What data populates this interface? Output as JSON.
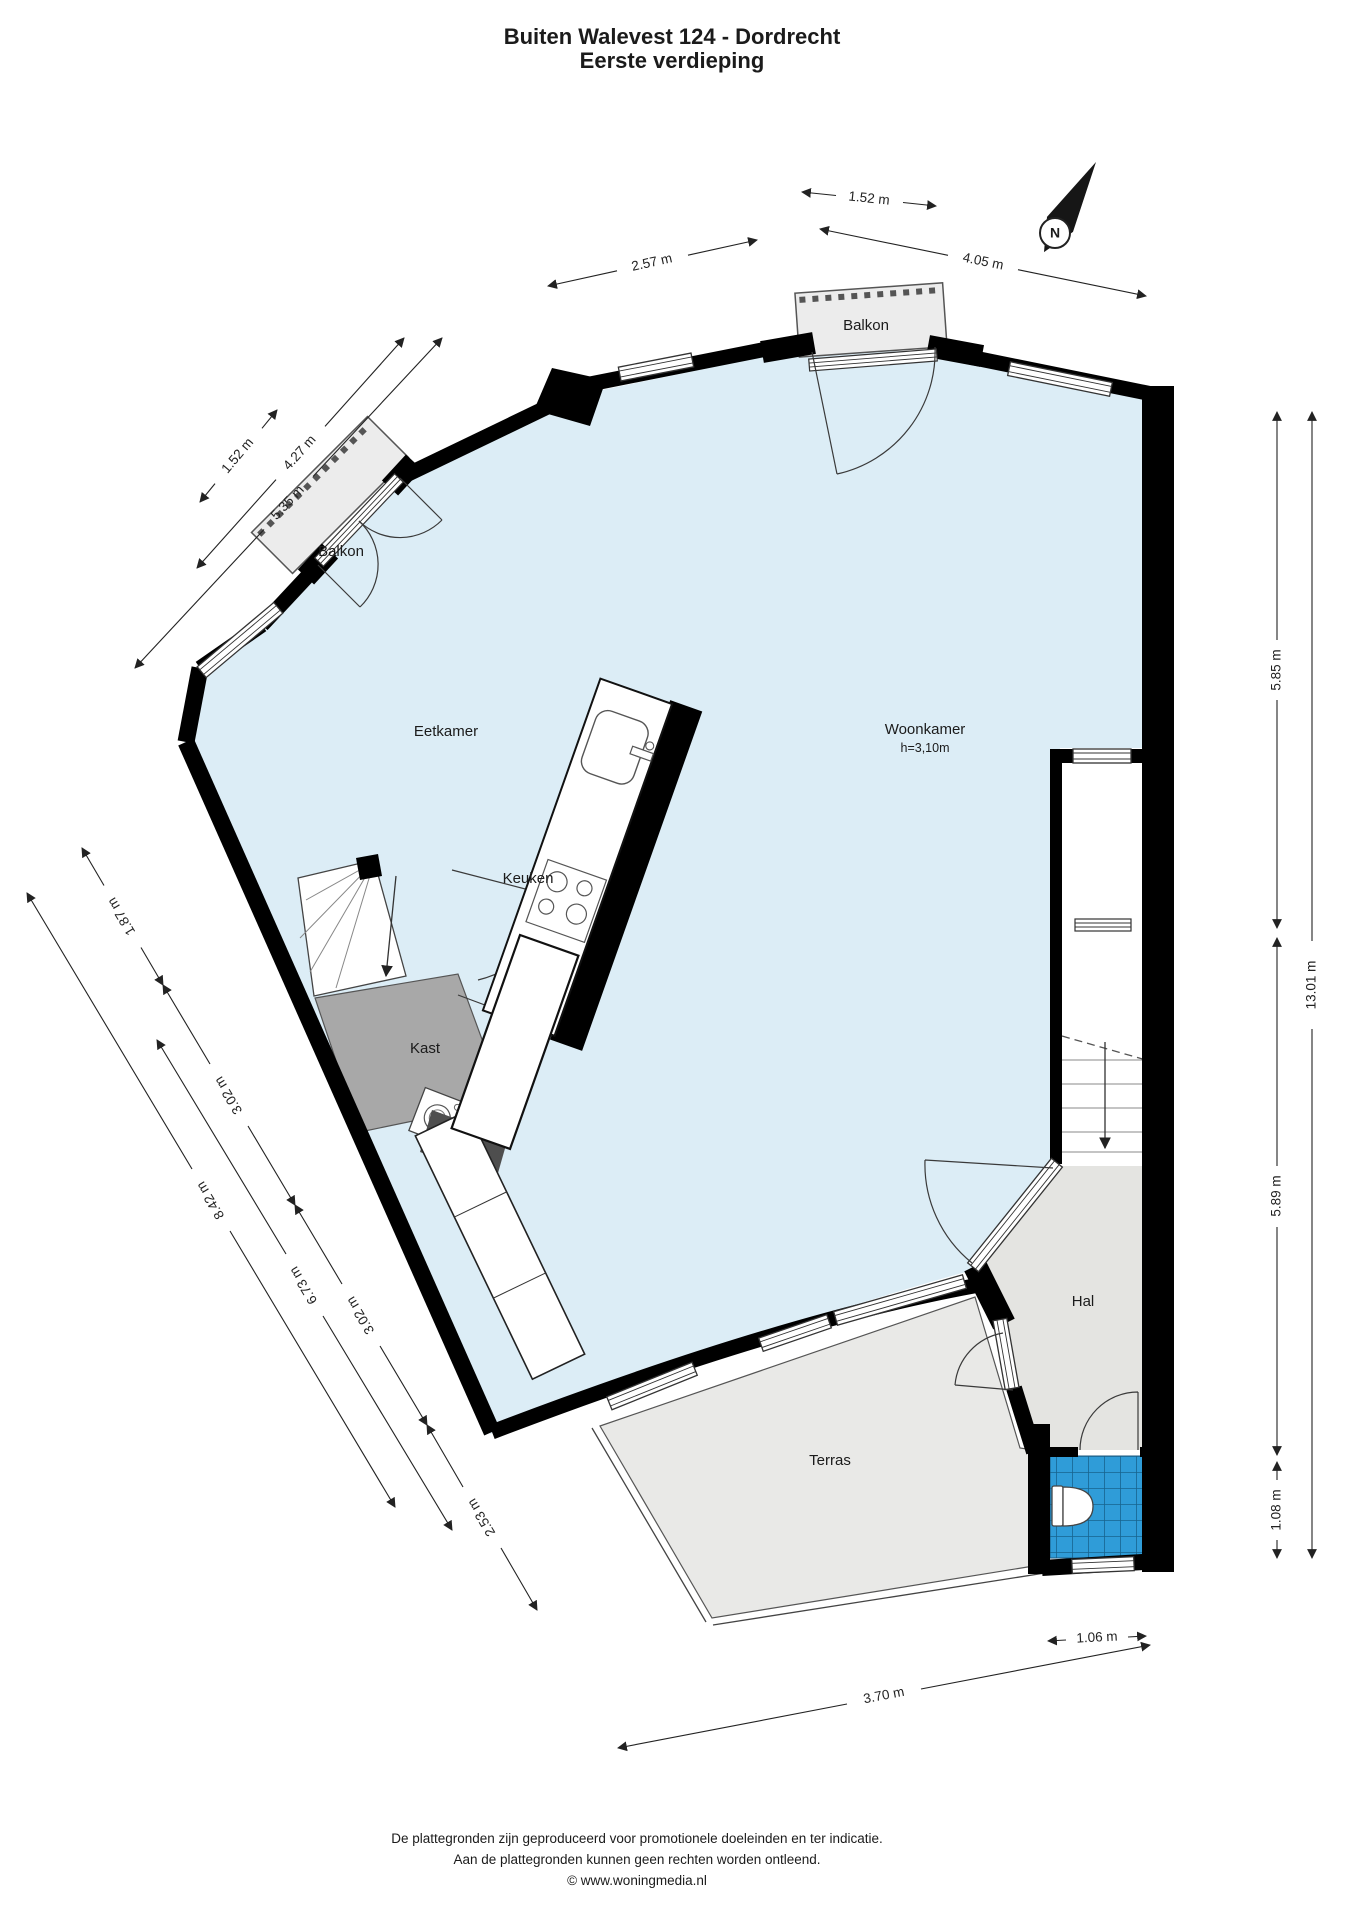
{
  "title": {
    "line1": "Buiten Walevest 124 - Dordrecht",
    "line2": "Eerste verdieping"
  },
  "compass": {
    "north_label": "N"
  },
  "rooms": {
    "balkon_top": "Balkon",
    "balkon_left": "Balkon",
    "eetkamer": "Eetkamer",
    "keuken": "Keuken",
    "woonkamer": "Woonkamer",
    "woonkamer_ceiling_height": "h=3,10m",
    "kast": "Kast",
    "hal": "Hal",
    "terras": "Terras"
  },
  "dimensions": {
    "top_balcony": "1.52 m",
    "top_left_wall": "2.57 m",
    "top_right_wall": "4.05 m",
    "upper_left_balcony": "1.52 m",
    "upper_left_wall": "4.27 m",
    "upper_left_total": "5.35 m",
    "left_seg1": "1.87 m",
    "left_seg2": "3.02 m",
    "left_seg3": "3.02 m",
    "left_seg4": "2.53 m",
    "left_total": "8.42 m",
    "left_partial": "6.73 m",
    "right_upper": "5.85 m",
    "right_lower": "5.89 m",
    "right_toilet": "1.08 m",
    "right_total": "13.01 m",
    "toilet_width": "1.06 m",
    "terrace_width": "3.70 m"
  },
  "footer": {
    "line1": "De plattegronden zijn geproduceerd voor promotionele doeleinden en ter indicatie.",
    "line2": "Aan de plattegronden kunnen geen rechten worden ontleend.",
    "line3": "© www.woningmedia.nl"
  },
  "colors": {
    "floor": "#dcedf6",
    "wall": "#000000",
    "hal_floor": "#e4e4e1",
    "terrace_floor": "#e9e9e7",
    "closet_floor": "#a8a8a8",
    "tile_blue": "#2f9cd8",
    "balcony_floor": "#ececec"
  }
}
